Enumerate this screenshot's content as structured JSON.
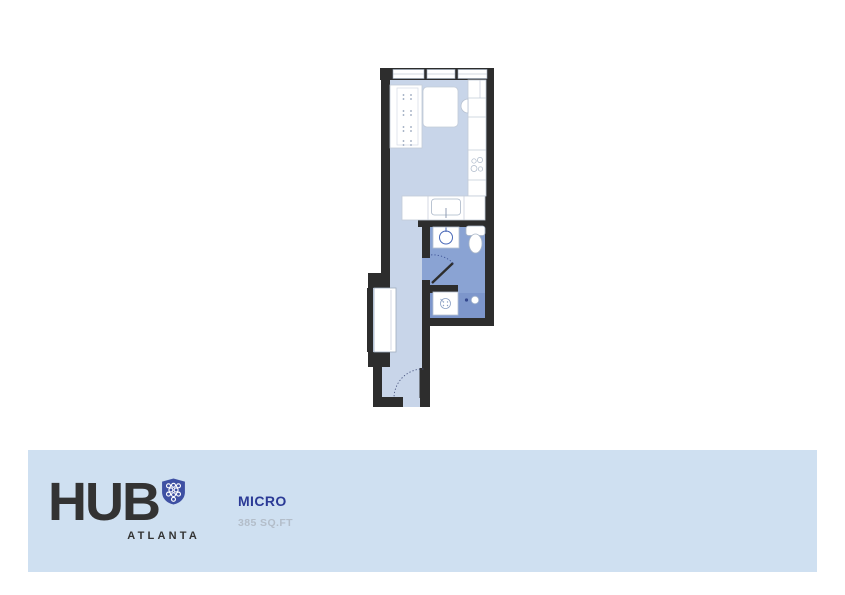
{
  "branding": {
    "name": "HUB",
    "city": "ATLANTA",
    "logo_icon": "shield-honeycomb-icon",
    "brand_color": "#3e50a3",
    "text_color": "#333333"
  },
  "unit": {
    "name": "MICRO",
    "area": "385 SQ.FT",
    "name_color": "#2b3a96",
    "area_color": "#b3bdc9"
  },
  "banner": {
    "background": "#cfe0f1"
  },
  "floor_plan": {
    "colors": {
      "wall": "#2d2d2d",
      "floor_main": "#c8d5e9",
      "floor_bathroom": "#8aa3d3",
      "floor_shower": "#7d96cb",
      "fixture_fill": "#ffffff",
      "fixture_stroke": "#b7c2d2",
      "plumbing_accent": "#4a69b8"
    },
    "fixtures": [
      "windows",
      "murphy-bed-unit",
      "bed",
      "kitchen-counter",
      "cooktop-burners",
      "kitchen-sink",
      "counter-appliance",
      "bathroom-washbasin",
      "toilet",
      "shower",
      "shower-control",
      "closet",
      "bathroom-door",
      "entry-door"
    ]
  }
}
